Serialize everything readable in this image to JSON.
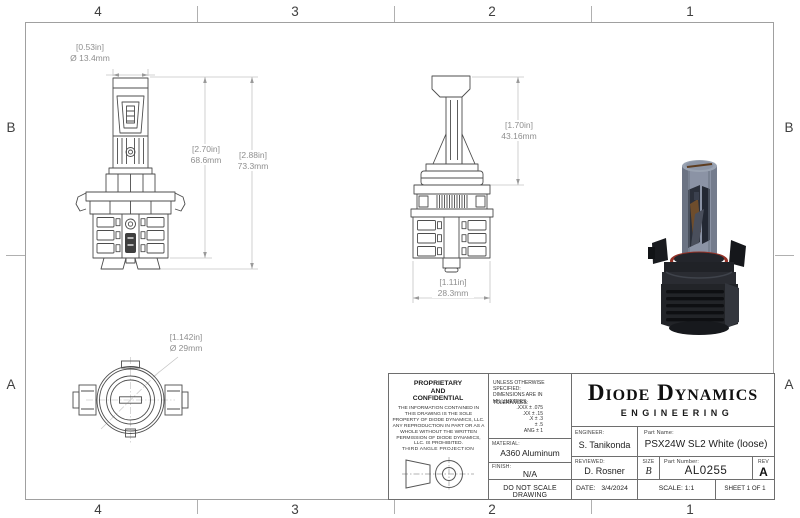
{
  "sheet": {
    "zones_top": [
      "4",
      "3",
      "2",
      "1"
    ],
    "zones_bottom": [
      "4",
      "3",
      "2",
      "1"
    ],
    "zones_left": [
      "B",
      "A"
    ],
    "zones_right": [
      "B",
      "A"
    ]
  },
  "dimensions": {
    "bulb_diameter": {
      "in": "[0.53in]",
      "mm": "Ø 13.4mm"
    },
    "body_height": {
      "in": "[2.70in]",
      "mm": "68.6mm"
    },
    "overall_height": {
      "in": "[2.88in]",
      "mm": "73.3mm"
    },
    "blade_height": {
      "in": "[1.70in]",
      "mm": "43.16mm"
    },
    "base_width": {
      "in": "[1.11in]",
      "mm": "28.3mm"
    },
    "flange_diameter": {
      "in": "[1.142in]",
      "mm": "Ø 29mm"
    }
  },
  "title_block": {
    "proprietary_title": "PROPRIETARY\nAND\nCONFIDENTIAL",
    "proprietary_body": "THE INFORMATION CONTAINED IN THIS DRAWING IS THE SOLE PROPERTY OF DIODE DYNAMICS, LLC.  ANY REPRODUCTION IN PART OR AS A WHOLE WITHOUT THE WRITTEN PERMISSION OF DIODE DYNAMICS, LLC. IS PROHIBITED.",
    "projection_label": "THIRD ANGLE PROJECTION",
    "unless_line1": "UNLESS OTHERWISE SPECIFIED:",
    "unless_line2": "DIMENSIONS ARE IN MILLIMETERS",
    "tolerances_label": "TOLERANCES:",
    "tolerances": [
      ".XXX ±  .075",
      ".XX ±  .15",
      ".X ±  .3",
      "±  .5",
      "ANG ±  1"
    ],
    "material_label": "MATERIAL:",
    "material_value": "A360 Aluminum",
    "finish_label": "FINISH:",
    "finish_value": "N/A",
    "do_not_scale": "DO NOT SCALE DRAWING",
    "company_name": "Diode Dynamics",
    "company_sub": "ENGINEERING",
    "engineer_label": "ENGINEER:",
    "engineer_value": "S. Tanikonda",
    "part_name_label": "Part Name:",
    "part_name_value": "PSX24W SL2 White (loose)",
    "reviewed_label": "REVIEWED:",
    "reviewed_value": "D. Rosner",
    "size_label": "SIZE",
    "size_value": "B",
    "part_number_label": "Part Number:",
    "part_number_value": "AL0255",
    "rev_label": "REV",
    "rev_value": "A",
    "date_label": "DATE:",
    "date_value": "3/4/2024",
    "scale_text": "SCALE: 1:1",
    "sheet_text": "SHEET 1 OF 1"
  },
  "colors": {
    "part_line": "#4d4d4d",
    "dim_line": "#c4c4c4",
    "dim_text": "#8f8f8f",
    "oring_red": "#943227",
    "render_body": "#8b93a5"
  }
}
